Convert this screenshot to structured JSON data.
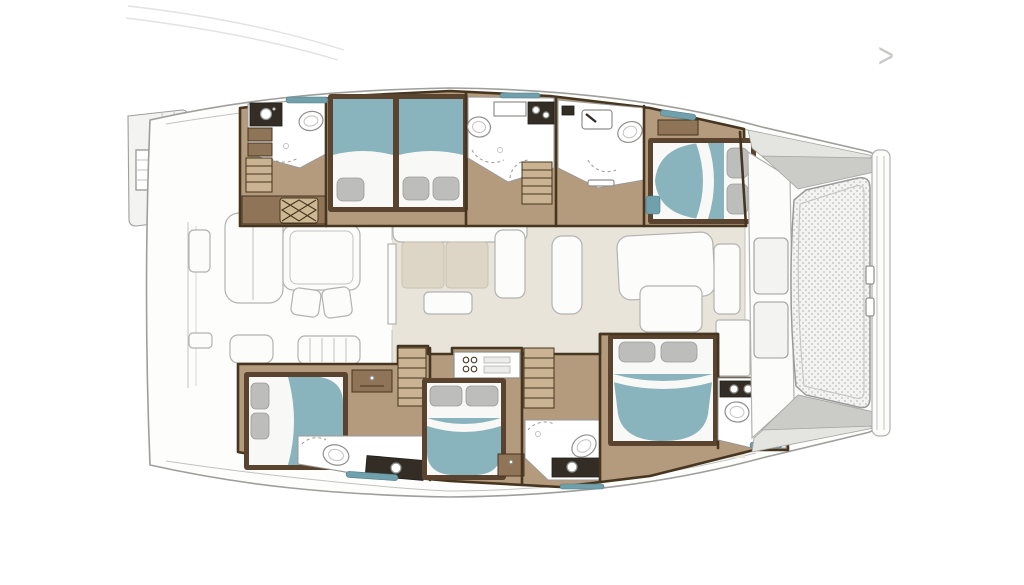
{
  "ui": {
    "next_arrow": ">"
  },
  "colors": {
    "hull_fill": "#fdfdfc",
    "hull_stroke": "#9e9e9c",
    "line_soft": "#c2c2c0",
    "faint_line": "#e2e2e0",
    "deck": "#f3f3f1",
    "saloon_floor": "#e9e4da",
    "wood_floor": "#b49b7e",
    "wood_lite": "#c9b392",
    "wood_mid": "#8f7457",
    "wood_dark": "#5a4430",
    "wall": "#46351f",
    "teal": "#89b4bd",
    "teal_deep": "#6fa0ac",
    "sheet": "#f8f8f6",
    "pillow": "#bdbdbb",
    "counter_dark": "#332d26",
    "bath_floor": "#ffffff",
    "wedge_lite": "#e4e4e0",
    "wedge_dark": "#cbcbc7",
    "cushion": "#ddd5c6",
    "mesh_bg": "#f3f3f1",
    "mesh_dot": "#c9c9c7",
    "arrow_gray": "#c7c7c5"
  },
  "rooms": {
    "plan": "Catamaran yacht deck floor plan",
    "hull": "Catamaran hull and deck",
    "port_transom": "Port swim platform",
    "stbd_transom": "Starboard swim platform",
    "cockpit": "Aft cockpit",
    "cockpit_table": "Cockpit dining table",
    "cockpit_lounge": "Cockpit lounge seat",
    "saloon": "Saloon",
    "saloon_sofa": "Saloon L-sofa",
    "coffee_table": "Coffee table",
    "chaise": "Saloon chaise",
    "fwd_lounge": "Forward lounge seat",
    "galley": "Galley counter",
    "port_aft_head": "Port aft bathroom",
    "port_mid_cabin": "Port guest cabin",
    "port_mid_head": "Port mid bathroom",
    "port_fwd_head": "Port forward bathroom",
    "port_fwd_cabin": "Port forward cabin",
    "stbd_aft_cabin": "Starboard aft cabin",
    "stbd_aft_head": "Starboard aft bathroom",
    "stbd_mid_cabin": "Starboard mid cabin",
    "stbd_mid_head": "Starboard mid bathroom",
    "stbd_fwd_cabin": "Starboard forward cabin",
    "stbd_fwd_head": "Starboard forward bathroom",
    "stairs_port_aft": "Port aft stairs",
    "stairs_port": "Port companionway stairs",
    "stairs_stbd_aft": "Starboard aft stairs",
    "stairs_stbd": "Starboard companionway stairs",
    "foredeck": "Foredeck lockers",
    "trampoline": "Bow trampoline",
    "bow_beam": "Bow crossbeam"
  }
}
